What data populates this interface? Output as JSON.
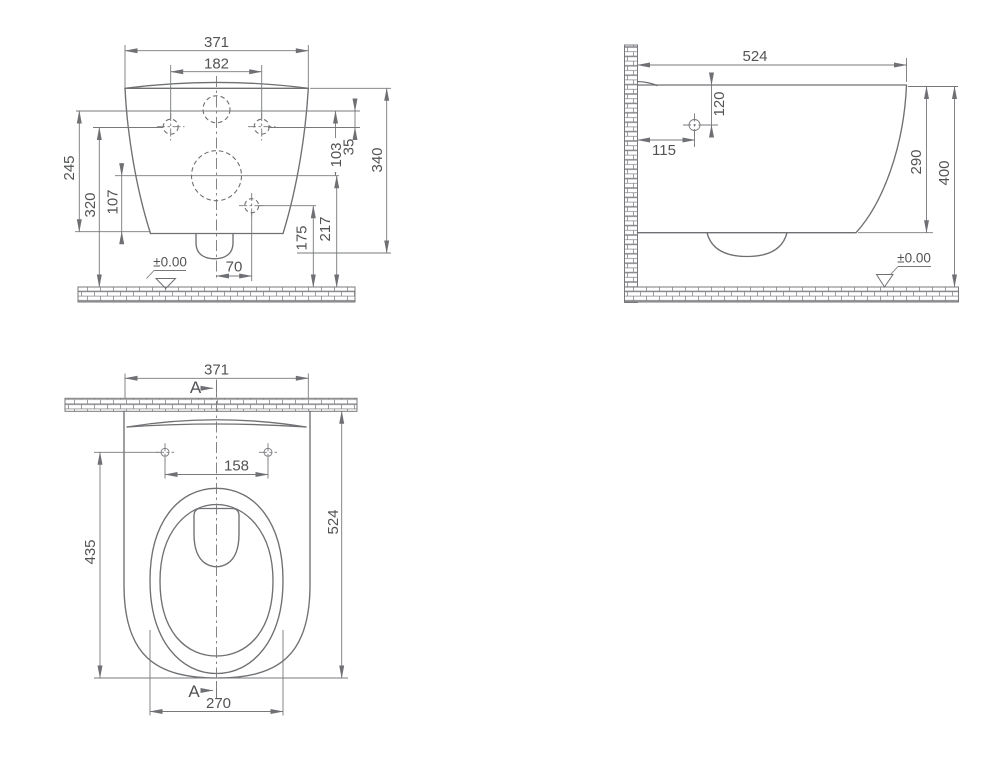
{
  "drawing": {
    "type": "technical-dimension-drawing",
    "subject": "wall-hung toilet, three orthographic views",
    "colors": {
      "line": "#6f7073",
      "text": "#525355",
      "background": "#ffffff"
    },
    "views": {
      "front": {
        "dim_width": "371",
        "dim_wall_hole_spacing": "182",
        "dim_245": "245",
        "dim_320": "320",
        "dim_107": "107",
        "dim_103": "103",
        "dim_35": "35",
        "dim_340": "340",
        "dim_217": "217",
        "dim_175": "175",
        "dim_70": "70",
        "datum": "±0.00"
      },
      "side": {
        "dim_depth": "524",
        "dim_120": "120",
        "dim_115": "115",
        "dim_290": "290",
        "dim_400": "400",
        "datum": "±0.00"
      },
      "top": {
        "dim_width": "371",
        "dim_seat_hole_spacing": "158",
        "dim_435": "435",
        "dim_524": "524",
        "dim_270": "270",
        "section_top": "A",
        "section_bottom": "A"
      }
    }
  }
}
